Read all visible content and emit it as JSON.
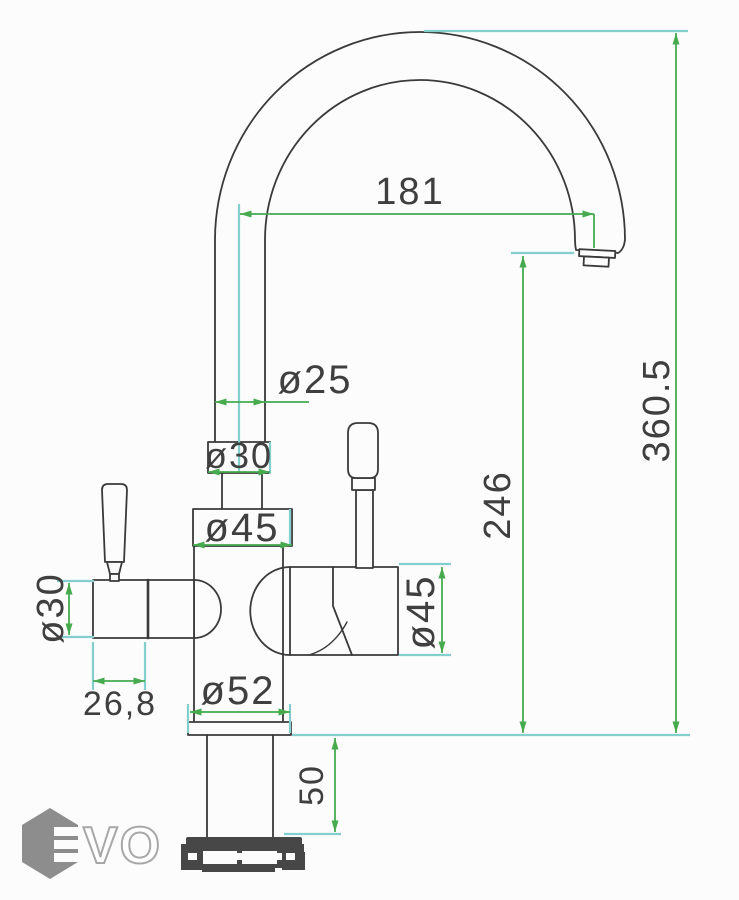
{
  "drawing": {
    "type": "faucet-technical-drawing",
    "dims": {
      "reach": "181",
      "total_height": "360.5",
      "spout_height": "246",
      "spout_tube_d": "ø25",
      "upper_collar_d": "ø30",
      "body_collar_d": "ø45",
      "left_valve_d": "ø30",
      "left_valve_len": "26,8",
      "right_valve_d": "ø45",
      "base_d": "ø52",
      "shank_len": "50"
    },
    "colors": {
      "outline": "#3a3a3a",
      "dimension_line": "#46ab4e",
      "extension_line": "#82cfcd",
      "label_text": "#3f3f3f",
      "watermark_gray": "#8d8d8d",
      "nut_fill": "#474747",
      "background": "#fcfcfc"
    },
    "watermark": {
      "letters": "VO"
    }
  }
}
